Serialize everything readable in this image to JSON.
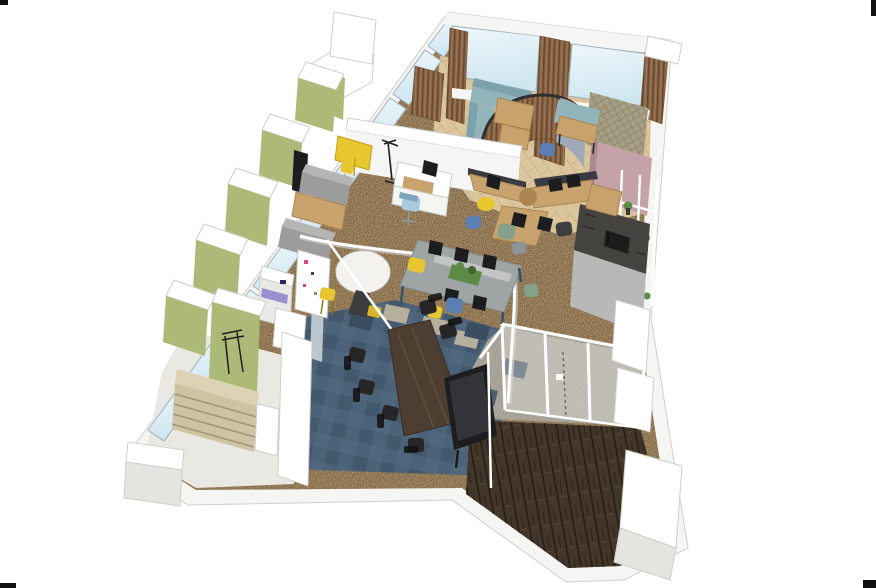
{
  "meta": {
    "title": "Isometric 3D render of an office floor plan",
    "render_style": "axonometric architectural visualization",
    "background": "white with four small black corner crop marks"
  },
  "palette": {
    "bg": "#ffffff",
    "mark": "#111111",
    "wallWhite": "#f5f5f3",
    "wallShade": "#e4e4e0",
    "wallEdge": "#cfcfca",
    "glass": "#d9ecf5",
    "glassDeep": "#c3dcea",
    "frameGray": "#9fb2bc",
    "slatWood": "#8a6547",
    "slatDark": "#64472e",
    "greenCab": "#adb976",
    "greenCabDark": "#8e9c5a",
    "woodFloor": "#dcc69e",
    "woodFloorLine": "#c0a87d",
    "carpet": "#b2946a",
    "carpetDark": "#7e6647",
    "blueCarpet": "#4b6278",
    "blueCarpetDark": "#394c60",
    "tileBeige": "#b7af9d",
    "grayCarpet": "#b5b0a4",
    "darkWood": "#42352a",
    "darkWoodLine": "#281e14",
    "tealSofa": "#92b4bb",
    "tealSofaDark": "#7ca3ab",
    "deskWood": "#c9a36e",
    "deskWoodDark": "#ab8551",
    "grayTable": "#9fa4a4",
    "grayTableDark": "#868b8c",
    "walnut": "#4e3e31",
    "walnutLight": "#6a543f",
    "black": "#262626",
    "monitor": "#1d1d20",
    "yellow": "#e7c62f",
    "yellowDark": "#bfa014",
    "blueChair": "#5b7fb3",
    "lightBlueChair": "#aac8de",
    "greenChair": "#86a18b",
    "navyChair": "#23357d",
    "pink": "#c5a2a7",
    "pinkDark": "#a98a8f",
    "quilt": "#a69f86",
    "quiltLine": "#8a english",
    "kitchenDark": "#454340",
    "kitchenLight": "#b8b8b6",
    "plant": "#5d8a46",
    "plantDark": "#3f6630",
    "shelfTan": "#cfc3a2",
    "shelfLine": "#a2967a",
    "copier": "#e9e9e7",
    "paleFloor": "#eae8e3",
    "grayPanel": "#9fa9b9",
    "magenta": "#d8488c",
    "railWhite": "#ffffff"
  },
  "scene": {
    "zones": [
      {
        "name": "lounge-corner",
        "floor": "light-wood-herringbone",
        "position": "top"
      },
      {
        "name": "open-office",
        "floor": "brown-speckled-carpet",
        "position": "center"
      },
      {
        "name": "meeting-area",
        "floor": "blue-carpet-tiles",
        "position": "bottom-center"
      },
      {
        "name": "entrance-vestibule",
        "floor": "dark-wood-planks",
        "position": "bottom-right"
      },
      {
        "name": "storage-corner",
        "floor": "pale-gray",
        "position": "bottom-left"
      }
    ],
    "furniture": [
      "window-wall-with-glass-panes",
      "olive-green-lockers",
      "wood-slat-panels",
      "teal-l-sofa",
      "curved-slat-screen",
      "hanging-wood-table",
      "navy-lounge-chair",
      "yellow-cafe-table-and-chairs",
      "gray-booth-benches-with-wood-table",
      "white-l-desk-with-light-blue-chair",
      "120-degree-desk-cluster-with-monitors",
      "long-gray-bench-desk-with-planter-and-monitors",
      "yellow-and-blue-task-chairs",
      "round-white-table-with-yellow-stool",
      "copier",
      "storage-cabinet-with-magnets",
      "tall-beige-shelving",
      "black-coat-stand",
      "dark-walnut-meeting-table",
      "black-meeting-chairs",
      "presentation-display",
      "white-curved-guide-rail",
      "quilted-acoustic-panel",
      "pink-partition-panel",
      "white-plant-shelf",
      "dark-gray-kitchen-island",
      "white-cabinets",
      "glass-partition-with-white-frames"
    ]
  }
}
